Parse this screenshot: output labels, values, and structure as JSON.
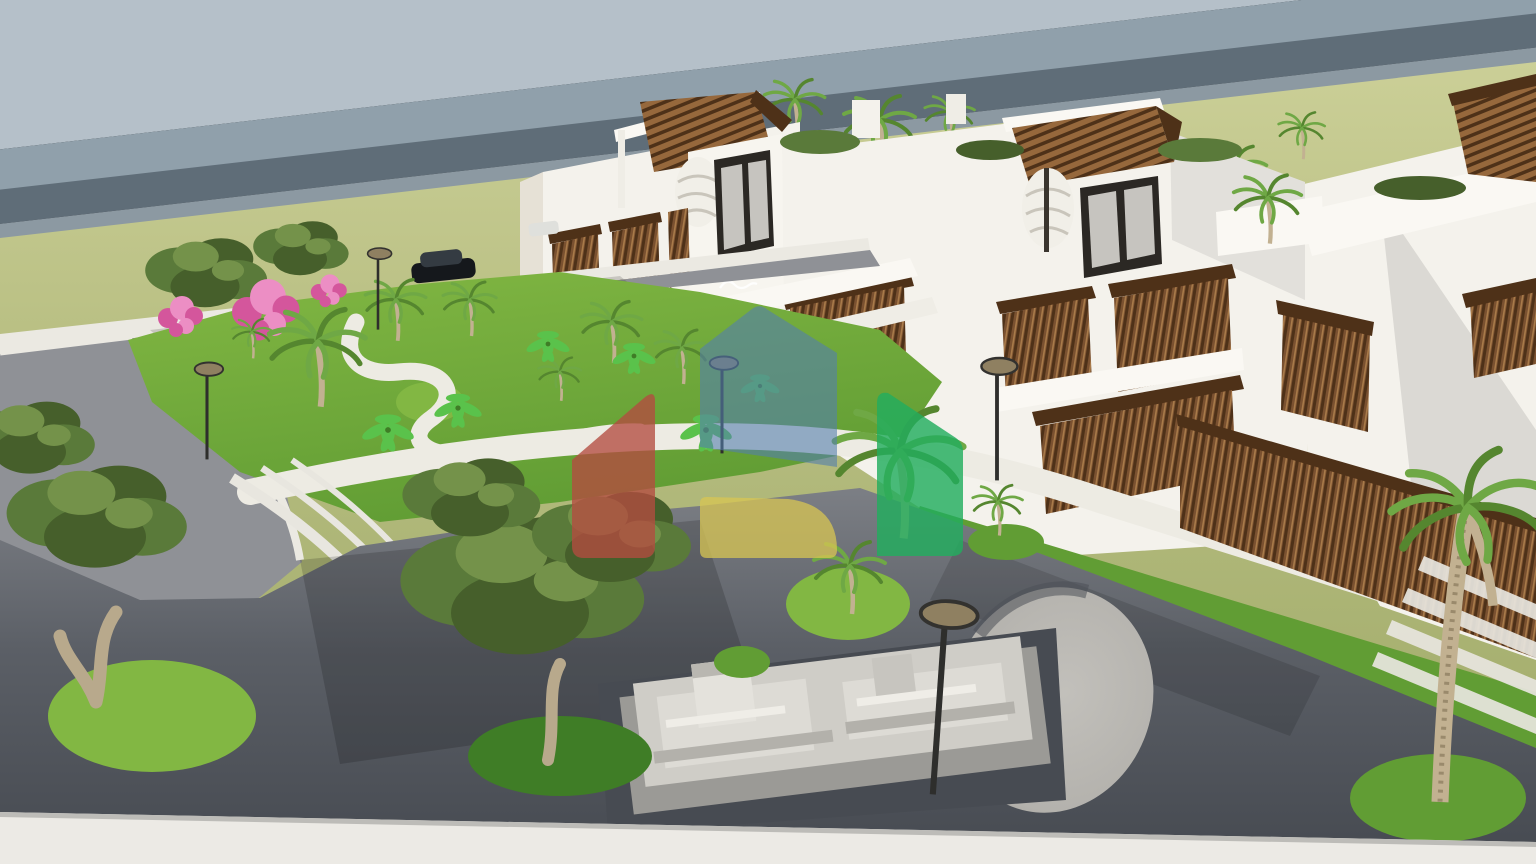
{
  "image": {
    "kind": "3d-architectural-render",
    "description": "Aerial 3D rendering of a modern white residential complex with wooden slat balconies and pergolas, palm-filled gardens with curved white paths, an internal asphalt road and plaza with a terraced stone feature and oval gravel mound, bordered by a perimeter wall and an olive-green field under a hazy grey-blue sky. A translucent real-estate house logo is watermarked over the centre.",
    "sign_on_tower": "illegible cursive script"
  },
  "palette": {
    "sky_top": "#b5c0c9",
    "sky_mid": "#90a0ab",
    "sky_band": "#5f6d78",
    "sky_glow": "#8c99a2",
    "field_light": "#cbcf97",
    "field": "#b6bd80",
    "field_dark": "#a2ac6b",
    "white": "#f4f2ec",
    "white_bright": "#faf8f3",
    "cream": "#e6e1d6",
    "shadow": "#d4cfc4",
    "shadow_deep": "#b6b1a5",
    "wood": "#96683c",
    "wood_mid": "#7a5130",
    "wood_dark": "#4e3118",
    "window": "#2b2824",
    "glass": "#c6c4bf",
    "grass_bright": "#82b743",
    "grass": "#619d34",
    "grass_dark": "#3f7d26",
    "road": "#5b5f66",
    "road_light": "#8f9196",
    "road_deep": "#474b52",
    "curb": "#ebe9e2",
    "path": "#edebe3",
    "stone": "#cfcdc7",
    "stone_dark": "#9b9a96",
    "mound": "#b4b2ad",
    "trunk": "#c2b191",
    "olive": "#5a7a3a",
    "olive_dark": "#465f2b",
    "olive_light": "#74924a",
    "palm": "#6fa845",
    "palm_dark": "#55862f",
    "banana": "#5ac24b",
    "pink": "#d4569c",
    "pink_light": "#ec8ec4",
    "lamp_head": "#8f8061",
    "lamp_pole": "#2e2e2c",
    "car_body": "#15181c",
    "car_roof": "#343b42",
    "bottom_wall": "#eceae5"
  },
  "watermark": {
    "name": "real-estate-house-logo",
    "colors": {
      "red": "#b44c40",
      "blue": "#537fae",
      "yellow": "#d8c653",
      "green": "#22ad5e"
    },
    "opacity": {
      "red": 0.78,
      "blue": 0.6,
      "yellow": 0.75,
      "green": 0.82
    }
  },
  "scene": {
    "items": "sky, sea-haze band, olive-green field, perimeter wall, entry drive, internal road with parked car, landscaped garden with curved paths, bougainvillea, banana plants, date palms, olive trees, amphitheater steps, white apartment blocks with wooden slat screens and rooftop pergolas, spiral stairs, long slat fence with walkway, crosswalk, oval gravel mound, terraced stone feature, street lamps, bottom perimeter wall"
  }
}
